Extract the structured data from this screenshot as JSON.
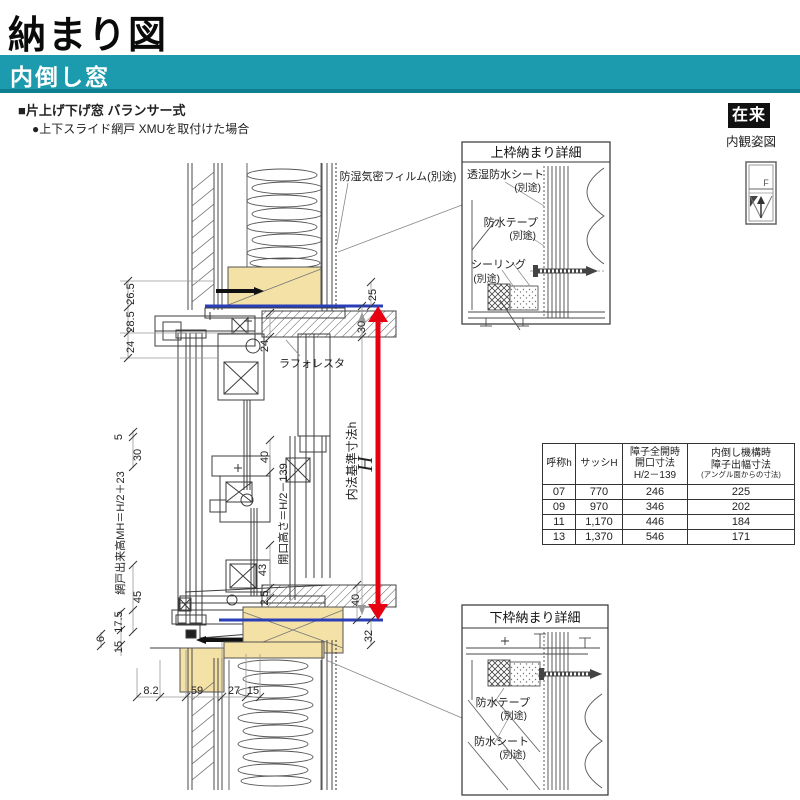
{
  "page": {
    "title": "納まり図"
  },
  "band": {
    "label": "内倒し窓"
  },
  "subtitle": {
    "line1": "■片上げ下げ窓 バランサー式",
    "line2": "●上下スライド網戸 XMUを取付けた場合"
  },
  "badge": {
    "label": "在来",
    "caption": "内観姿図",
    "icon_letter": "F"
  },
  "colors": {
    "accent_teal": "#1b9bad",
    "teal_dark": "#0e7f91",
    "wood_tan": "#f4e1a6",
    "ref_blue": "#2a3eb8",
    "ref_red": "#e60012"
  },
  "drawing": {
    "callouts": {
      "film": "防湿気密フィルム(別途)",
      "laforesta": "ラフォレスタ"
    },
    "axis": {
      "screen_mh": "網戸出来高MH＝H/2＋23",
      "opening_h": "開口高さ＝H/2－139",
      "naiho": "内法基準寸法h",
      "big_h": "H"
    },
    "dims": {
      "left_a": "26.5",
      "left_b": "28.5",
      "left_c": "24",
      "left_d": "5",
      "left_e": "30",
      "left_f": "45",
      "left_g": "17.5",
      "left_h": "15",
      "left_i": "6",
      "mid_a": "24",
      "mid_b": "24",
      "mid_c": "40",
      "mid_d": "43",
      "mid_e": "2.5",
      "right_a": "25",
      "right_b": "30",
      "right_c": "40",
      "right_d": "32",
      "bot_a": "8.2",
      "bot_b": "59",
      "bot_c": "27",
      "bot_d": "15"
    }
  },
  "detail_top": {
    "title": "上枠納まり詳細",
    "label1a": "透湿防水シート",
    "label1b": "(別途)",
    "label2a": "防水テープ",
    "label2b": "(別途)",
    "label3a": "シーリング",
    "label3b": "(別途)"
  },
  "detail_bottom": {
    "title": "下枠納まり詳細",
    "label1a": "防水テープ",
    "label1b": "(別途)",
    "label2a": "防水シート",
    "label2b": "(別途)"
  },
  "table": {
    "headers": {
      "col1": "呼称h",
      "col2": "サッシH",
      "col3": [
        "障子全開時",
        "開口寸法",
        "H/2－139"
      ],
      "col4": [
        "内倒し機構時",
        "障子出幅寸法",
        "(アングル面からの寸法)"
      ]
    },
    "rows": [
      [
        "07",
        "770",
        "246",
        "225"
      ],
      [
        "09",
        "970",
        "346",
        "202"
      ],
      [
        "11",
        "1,170",
        "446",
        "184"
      ],
      [
        "13",
        "1,370",
        "546",
        "171"
      ]
    ]
  }
}
